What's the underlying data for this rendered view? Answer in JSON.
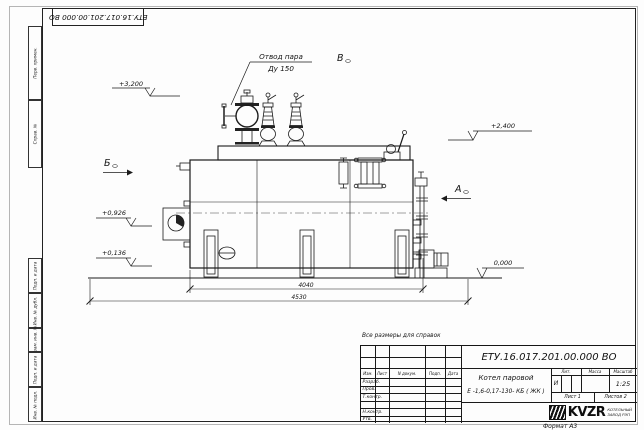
{
  "sheet": {
    "designation_top": "ЕТУ.16.017.201.00.000  ВО",
    "format_note": "Формат А3",
    "reference_note": "Все размеры для справок",
    "margin_labels": {
      "perv_primen": "Перв. примен.",
      "sprav_no": "Справ. №",
      "podp_data_1": "Подп. и дата",
      "inv_dubl": "Инв. № дубл.",
      "vzam_inv": "Взам. инв. №",
      "podp_data_2": "Подп. и дата",
      "inv_podl": "Инв. № подл."
    }
  },
  "drawing": {
    "callout_line1": "Отвод пара",
    "callout_line2": "Ду 150",
    "elevations": {
      "e_3200": "+3,200",
      "e_2400": "+2,400",
      "e_0926": "+0,926",
      "e_0136": "+0,136",
      "e_0000": "0,000"
    },
    "views": {
      "a": "А",
      "b": "Б",
      "v": "В"
    },
    "dimensions": {
      "inner": "4040",
      "outer": "4530"
    }
  },
  "title_block": {
    "designation": "ЕТУ.16.017.201.00.000  ВО",
    "product_name_line1": "Котел паровой",
    "product_name_line2": "Е -1,6-0,17-130- КБ ( ЖК )",
    "header": {
      "izm": "Изм.",
      "list": "Лист",
      "doc": "N докум.",
      "podp": "Подп.",
      "data": "Дата"
    },
    "row_razrab": "Разраб.",
    "row_prov": "Пров.",
    "row_tkontr": "Т.контр.",
    "row_nkontr": "Н.контр.",
    "row_utv": "Утв.",
    "lit_label": "Лит.",
    "massa_label": "Масса",
    "masshtab_label": "Масштаб",
    "lit_value": "И",
    "masshtab_value": "1:25",
    "sheet_no": "Лист 1",
    "sheets_total": "Листов 2",
    "org_logo": "KVZR",
    "org_name_line1": "КОТЕЛЬНЫЙ",
    "org_name_line2": "ЗАВОД РЭП"
  }
}
